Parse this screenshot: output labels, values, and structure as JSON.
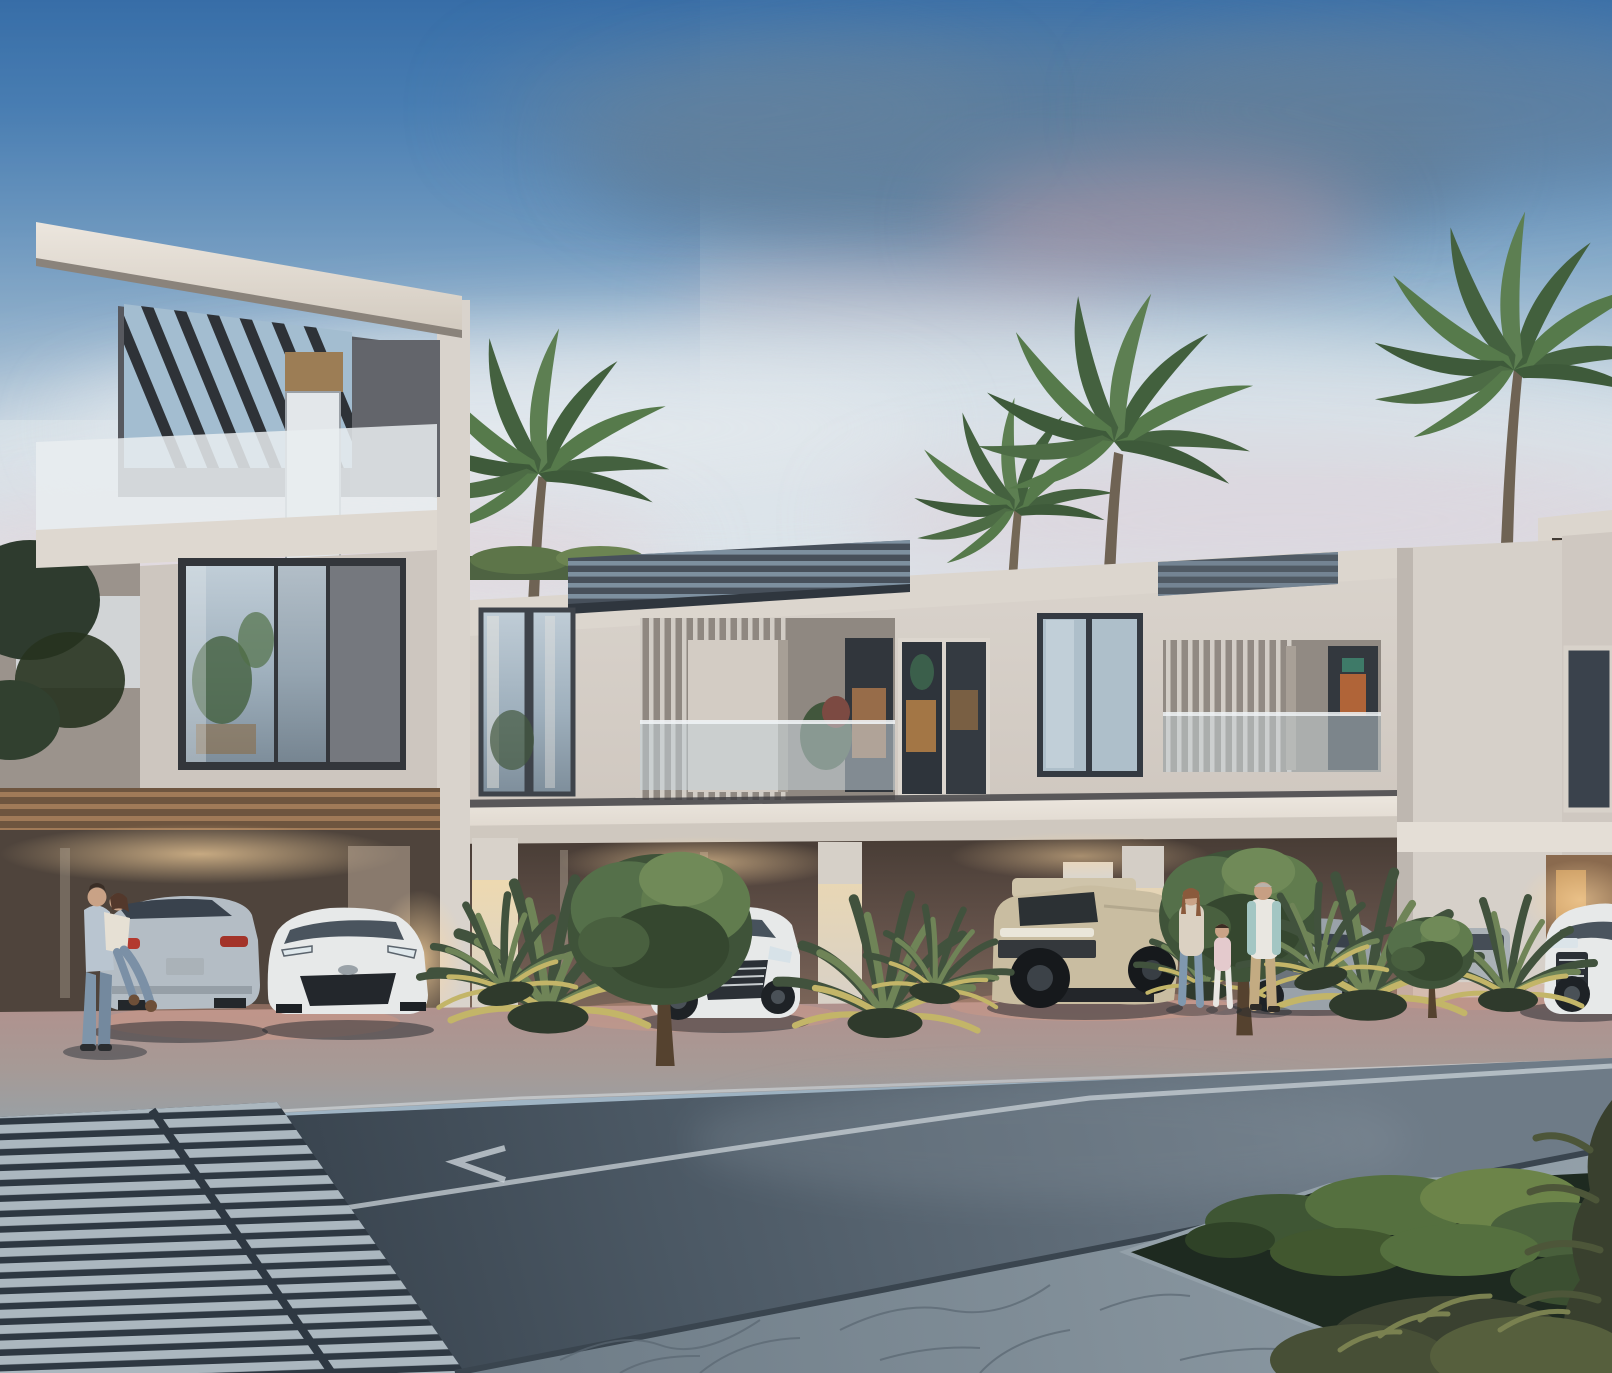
{
  "scene": {
    "kind": "architectural-rendering",
    "time_of_day": "dusk",
    "description": "Photorealistic render of a modern two/three-storey townhouse row with open carports, glass balconies, pergola roofs, palm trees, parked vehicles, pedestrians, and a foreground street with a worn zebra crossing, lane line, flagstone sidewalk and planter bed.",
    "visible_text": ""
  },
  "palette": {
    "sky_top": "#3a70a9",
    "sky_mid": "#7aa2c5",
    "sky_horizon": "#dbe2e7",
    "cloud_slate": "#5e7b97",
    "cloud_pink": "#c59ca6",
    "cloud_light": "#dce4ea",
    "stucco_light": "#d6d0c9",
    "stucco_shadow": "#9b938c",
    "fascia_white": "#dcd6ce",
    "roof_dark": "#4b5560",
    "recess_dark": "#57595f",
    "frosted_glass": "#e9edf0",
    "glass_blue": "#aebfca",
    "window_frame": "#343a42",
    "warm_interior": "#c08749",
    "carport_warm": "#6e5a4d",
    "glow_warm": "#ffd9a2",
    "apron_pink": "#b08f8b",
    "apron_gray": "#98a2a8",
    "road_dark": "#333d47",
    "road_light": "#6b7884",
    "marking_white": "#c9d1d7",
    "crosswalk_stripe": "#b6c2ca",
    "flagstone": "#7d8a94",
    "planter_green": "#55703f",
    "palm_green": "#4c6647",
    "palm_lit": "#c3b568",
    "car_silver": "#b4bdc5",
    "car_white": "#e7e9e9",
    "car_sand": "#c9bda1",
    "car_gray": "#9aa2a9"
  },
  "objects": {
    "buildings": [
      {
        "name": "left-tower",
        "storeys": 3,
        "features": [
          "slanted roof slab",
          "slatted pergola",
          "frosted glass balcony",
          "large triple window"
        ]
      },
      {
        "name": "townhouse-row",
        "storeys": 2,
        "features": [
          "louvered balconies",
          "glass balustrades",
          "warm-lit interiors",
          "open carports"
        ]
      },
      {
        "name": "right-block",
        "storeys": 2,
        "features": [
          "rooftop terrace with slatted canopy and palm",
          "dark corner window"
        ]
      }
    ],
    "vehicles": [
      {
        "name": "silver-fastback-suv",
        "color": "silver",
        "view": "rear"
      },
      {
        "name": "toyota-chr",
        "color": "white",
        "view": "front"
      },
      {
        "name": "audi-q8",
        "color": "white",
        "view": "front-three-quarter"
      },
      {
        "name": "hummer-ev",
        "color": "sand",
        "view": "front-three-quarter"
      },
      {
        "name": "gray-suv",
        "color": "gray",
        "view": "front"
      },
      {
        "name": "hidden-suv",
        "color": "gray",
        "view": "partial"
      },
      {
        "name": "audi-right",
        "color": "white",
        "view": "front-partial"
      }
    ],
    "people": [
      {
        "name": "embracing-couple",
        "count": 2,
        "location": "left carport"
      },
      {
        "name": "walking-family",
        "count": 3,
        "location": "sidewalk right of center"
      }
    ],
    "vegetation": [
      "background palms",
      "fan-palm shrubs",
      "round street trees",
      "planter groundcover",
      "foreground shrubs"
    ],
    "street": [
      "asphalt road",
      "solid lane line",
      "chevron marking",
      "worn zebra crossing",
      "flagstone sidewalk",
      "planter bed"
    ]
  }
}
